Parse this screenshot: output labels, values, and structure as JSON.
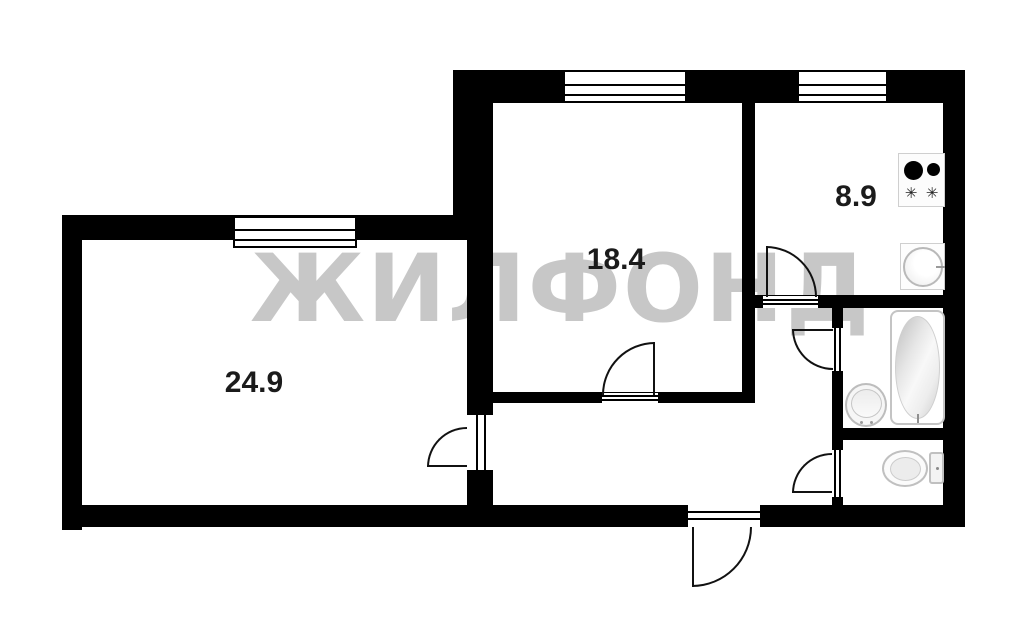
{
  "title": "Apartment floor plan",
  "watermark": {
    "text": "ЖИЛФОНД",
    "color": "#c7c7c7"
  },
  "rooms": [
    {
      "name": "living-room",
      "area": "24.9"
    },
    {
      "name": "room-2",
      "area": "18.4"
    },
    {
      "name": "kitchen",
      "area": "8.9"
    }
  ],
  "icons": {
    "burner_symbol": "✳",
    "stove": "stove-icon",
    "kitchen_sink": "kitchen-sink-icon",
    "bathtub": "bathtub-icon",
    "washbasin": "washbasin-icon",
    "toilet": "toilet-icon"
  },
  "colors": {
    "wall": "#000000",
    "background": "#ffffff",
    "watermark": "#c7c7c7",
    "fixture_outline": "#c0c0c0",
    "label_text": "#1b1b1b"
  }
}
